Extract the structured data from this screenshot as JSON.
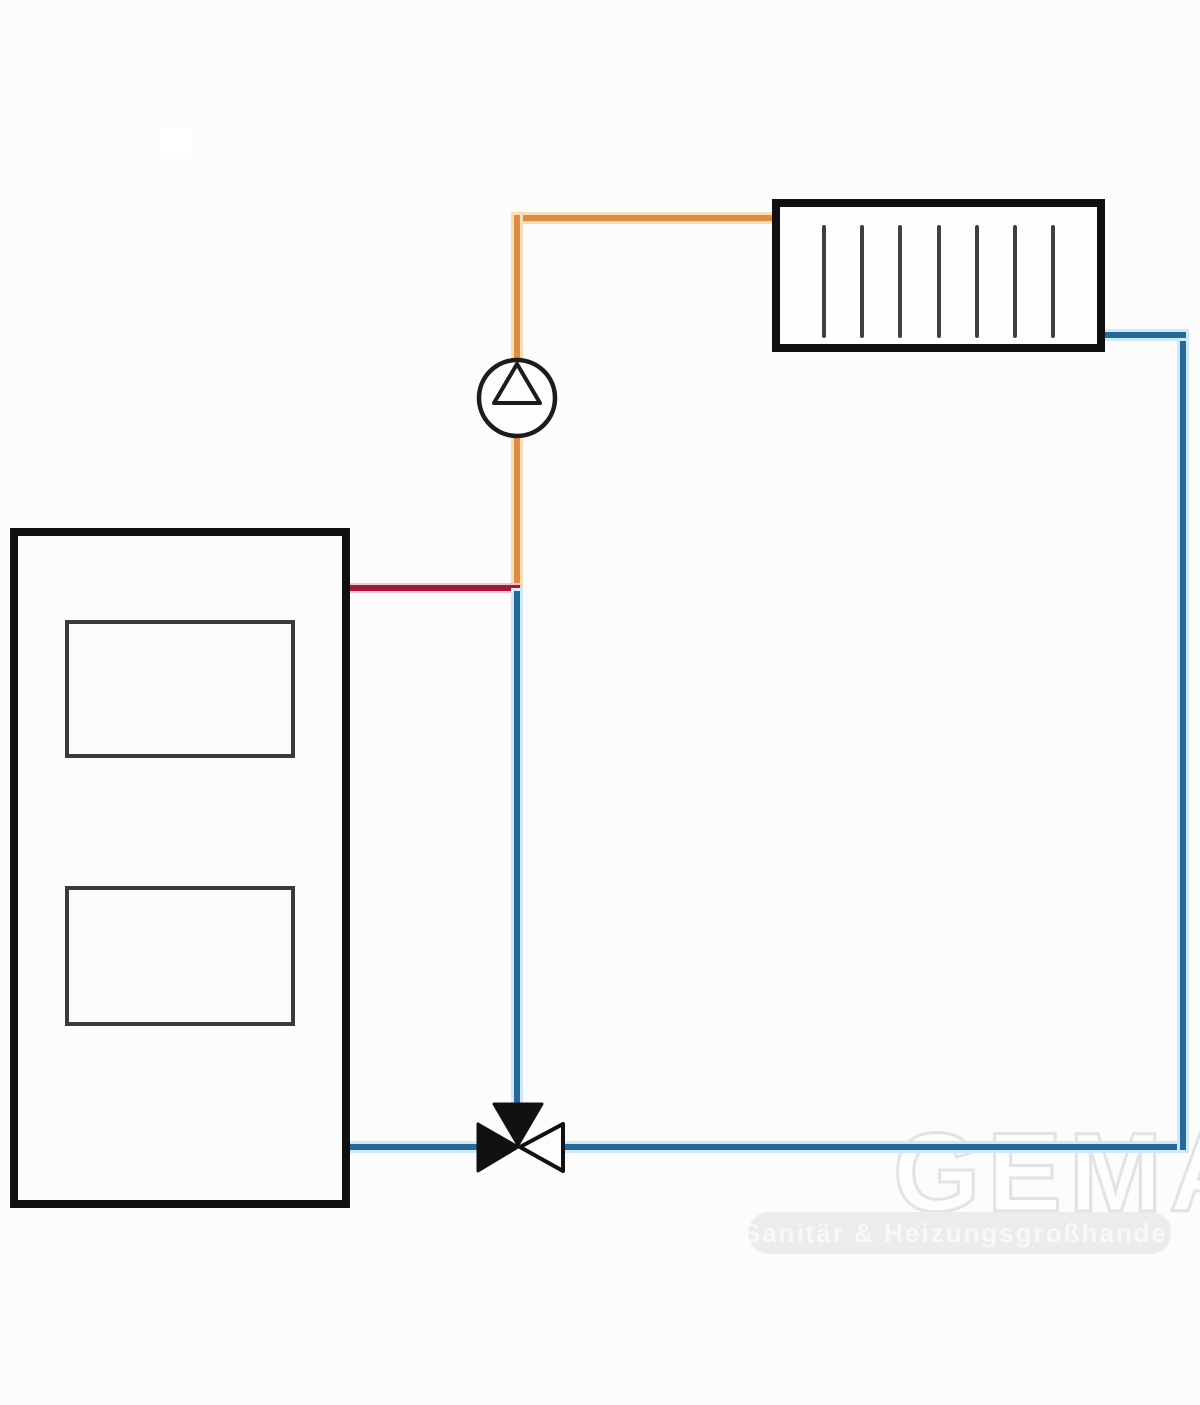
{
  "diagram": {
    "type": "heating-circuit-schematic",
    "components": {
      "boiler": {
        "name": "boiler",
        "ports": 2
      },
      "radiator": {
        "name": "radiator",
        "fin_count": 7
      },
      "pump": {
        "name": "circulation-pump"
      },
      "valve": {
        "name": "three-way-mixing-valve"
      }
    },
    "pipes": [
      {
        "name": "supply-pipe",
        "from": "pump-junction",
        "to": "radiator-left",
        "color": "#dd8c42"
      },
      {
        "name": "boiler-flow-pipe",
        "from": "boiler-right",
        "to": "riser-junction",
        "color": "#9e1b35"
      },
      {
        "name": "return-pipe",
        "from": "radiator-right",
        "to": "boiler-right-bottom",
        "color": "#236a99"
      }
    ]
  },
  "colors": {
    "supply_pipe": "#dd8c42",
    "supply_halo": "#f9ddb4",
    "return_pipe": "#236a99",
    "return_halo": "#cfe9f7",
    "boiler_flow_pipe": "#9e1b35",
    "boiler_flow_halo": "#ecc9d1",
    "outline": "#101010"
  },
  "watermark": {
    "brand": "GEMA",
    "tagline": "Sanitär & Heizungsgroßhandel"
  }
}
